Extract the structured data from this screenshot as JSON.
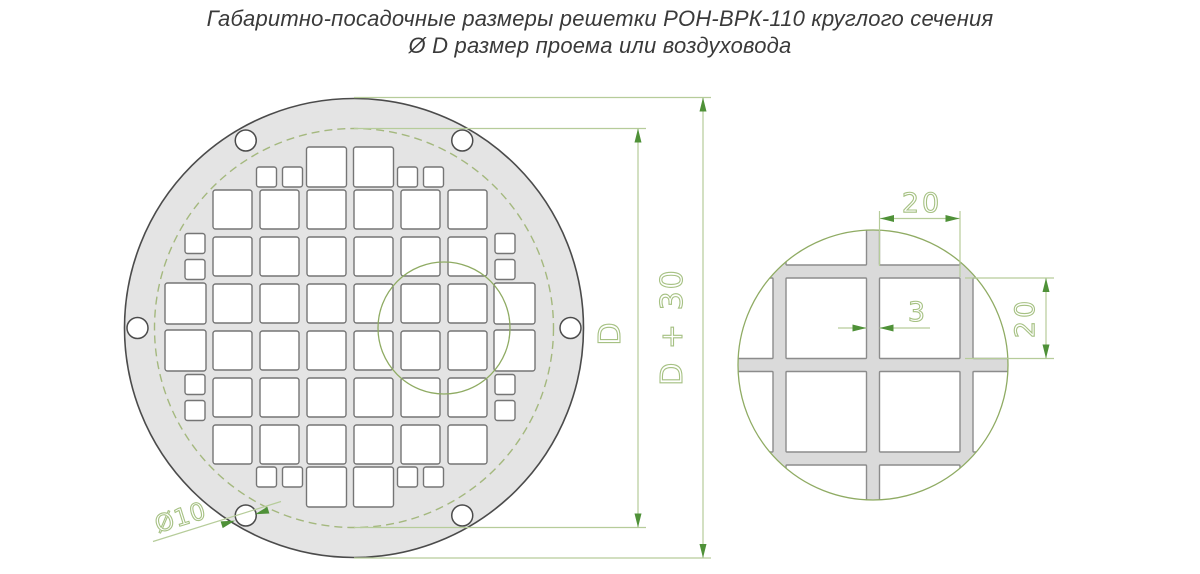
{
  "title": {
    "line1": "Габаритно-посадочные размеры решетки РОН-ВРК-110 круглого сечения",
    "line2": "Ø D размер проема или воздуховода"
  },
  "labels": {
    "outer_diameter": "D + 30",
    "duct_diameter": "D",
    "mounting_hole_diameter": "Ø10",
    "cell_width": "20",
    "cell_height": "20",
    "web_width": "3"
  },
  "colors": {
    "plate_fill": "#e4e4e4",
    "plate_stroke": "#4b4b4b",
    "square_stroke": "#757575",
    "detail_square_stroke": "#8c8c8c",
    "detail_bar_fill": "#dadada",
    "dim_line": "#b6cc9a",
    "arrow": "#4f9138",
    "label_stroke": "#a6c183",
    "dashed_circle": "#a4b87e",
    "zoom_circle": "#8fab63",
    "title_text": "#3a3a3a"
  },
  "main_view": {
    "cx": 354,
    "cy": 328,
    "outer_r": 229.5,
    "duct_r": 199.5,
    "bolt_circle_r": 216.5,
    "hole_r": 10.5,
    "hole_angles_deg": [
      0,
      60,
      120,
      180,
      240,
      300
    ],
    "zoom_region": {
      "cx": 444,
      "cy": 328,
      "r": 66
    },
    "grid": {
      "cx": 350,
      "cy": 327,
      "pitch": 47,
      "square": 39,
      "small": 20,
      "cap_big": 40,
      "wide_big": 41,
      "cap_shift": 5,
      "rows": [
        {
          "type": "cap",
          "big_cols": [
            4,
            5
          ],
          "pair_cols": [
            3,
            6
          ]
        },
        {
          "type": "band",
          "cols": [
            2,
            3,
            4,
            5,
            6,
            7
          ]
        },
        {
          "type": "band",
          "cols": [
            2,
            3,
            4,
            5,
            6,
            7
          ],
          "stack_cols": [
            1,
            8
          ]
        },
        {
          "type": "wide",
          "cols": [
            1,
            2,
            3,
            4,
            5,
            6,
            7,
            8
          ]
        },
        {
          "type": "wide",
          "cols": [
            1,
            2,
            3,
            4,
            5,
            6,
            7,
            8
          ]
        },
        {
          "type": "band",
          "cols": [
            2,
            3,
            4,
            5,
            6,
            7
          ],
          "stack_cols": [
            1,
            8
          ]
        },
        {
          "type": "band",
          "cols": [
            2,
            3,
            4,
            5,
            6,
            7
          ]
        },
        {
          "type": "cap",
          "big_cols": [
            4,
            5
          ],
          "pair_cols": [
            3,
            6
          ]
        }
      ]
    }
  },
  "detail_view": {
    "cx": 873,
    "cy": 365,
    "r": 135,
    "bar_w": 13,
    "v_bar_x": [
      779.5,
      873,
      966.5
    ],
    "h_bar_y": [
      271.5,
      365,
      458.5
    ],
    "x_cells": [
      [
        693,
        773
      ],
      [
        786,
        866.5
      ],
      [
        879.5,
        960
      ],
      [
        973,
        1053
      ]
    ],
    "y_cells": [
      [
        185,
        265
      ],
      [
        278,
        358.5
      ],
      [
        371.5,
        452
      ],
      [
        465,
        545
      ]
    ]
  }
}
